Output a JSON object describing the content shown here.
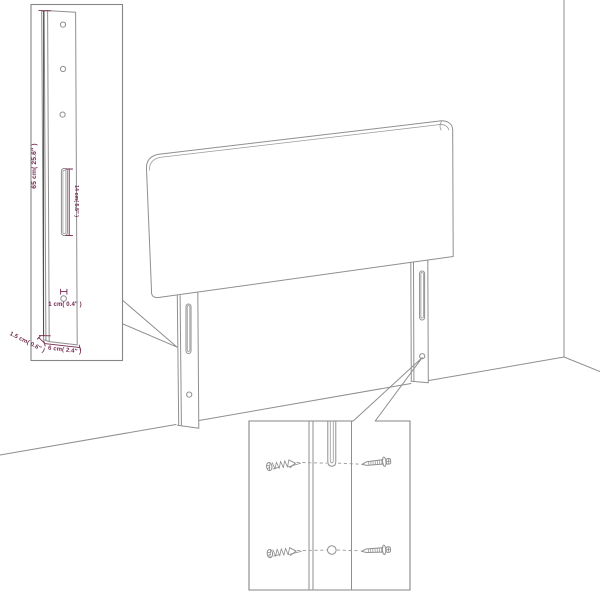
{
  "diagram": {
    "title": "Headboard dimension and assembly diagram",
    "description": "Line drawing of an upholstered headboard with two mounting legs standing in a room corner; top-left inset shows leg dimensions, bottom-right inset shows screw mounting detail",
    "colors": {
      "line": "#8f8f8f",
      "dimension_accent": "#73294e",
      "background": "#ffffff"
    },
    "dimension_inset": {
      "labels": {
        "leg_height": "65 cm( 25.6″ )",
        "slot_length": "14 cm( 5.5″ )",
        "hole_diameter": "1 cm( 0.4″ )",
        "leg_thickness": "1.5 cm( 0.6″ )",
        "leg_width": "6 cm( 2.4″ )"
      },
      "hole_count": 3
    },
    "screw_inset": {
      "screw_count": 4,
      "slot_count": 1,
      "hole_count": 1
    }
  }
}
